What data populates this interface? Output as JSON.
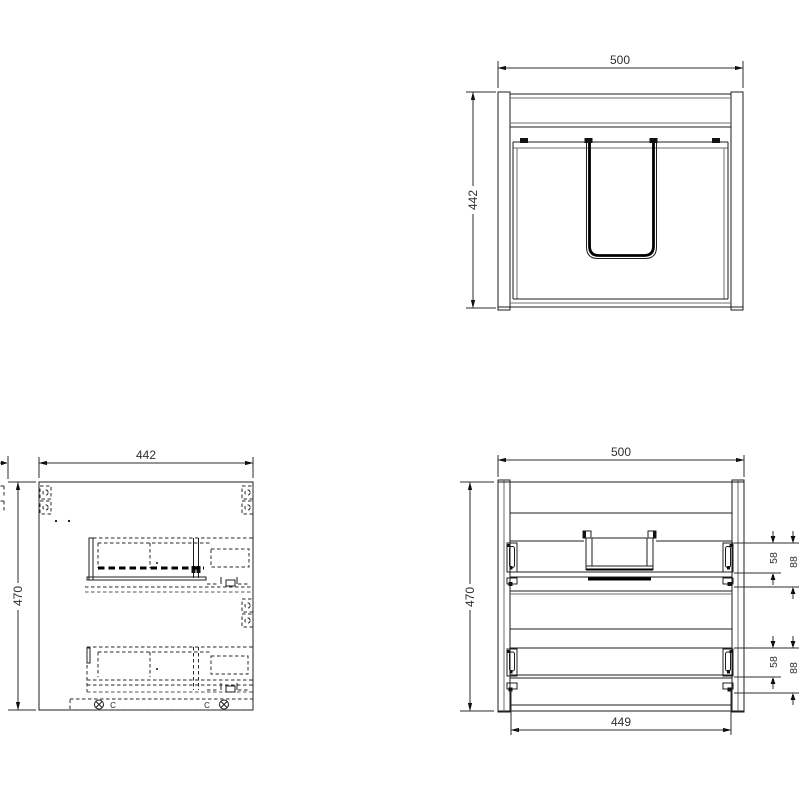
{
  "drawing": {
    "background": "#ffffff",
    "line_color": "#1c1c1c",
    "views": {
      "back_view": {
        "width_label": "500",
        "height_label": "442"
      },
      "side_view": {
        "width_label": "442",
        "height_label": "470",
        "screw_label_left": "C",
        "screw_label_right": "C"
      },
      "front_view": {
        "width_label": "500",
        "height_label": "470",
        "inner_width_label": "449",
        "top_drawer": {
          "offset_label": "58",
          "height_label": "88"
        },
        "bottom_drawer": {
          "offset_label": "58",
          "height_label": "88"
        }
      }
    }
  }
}
